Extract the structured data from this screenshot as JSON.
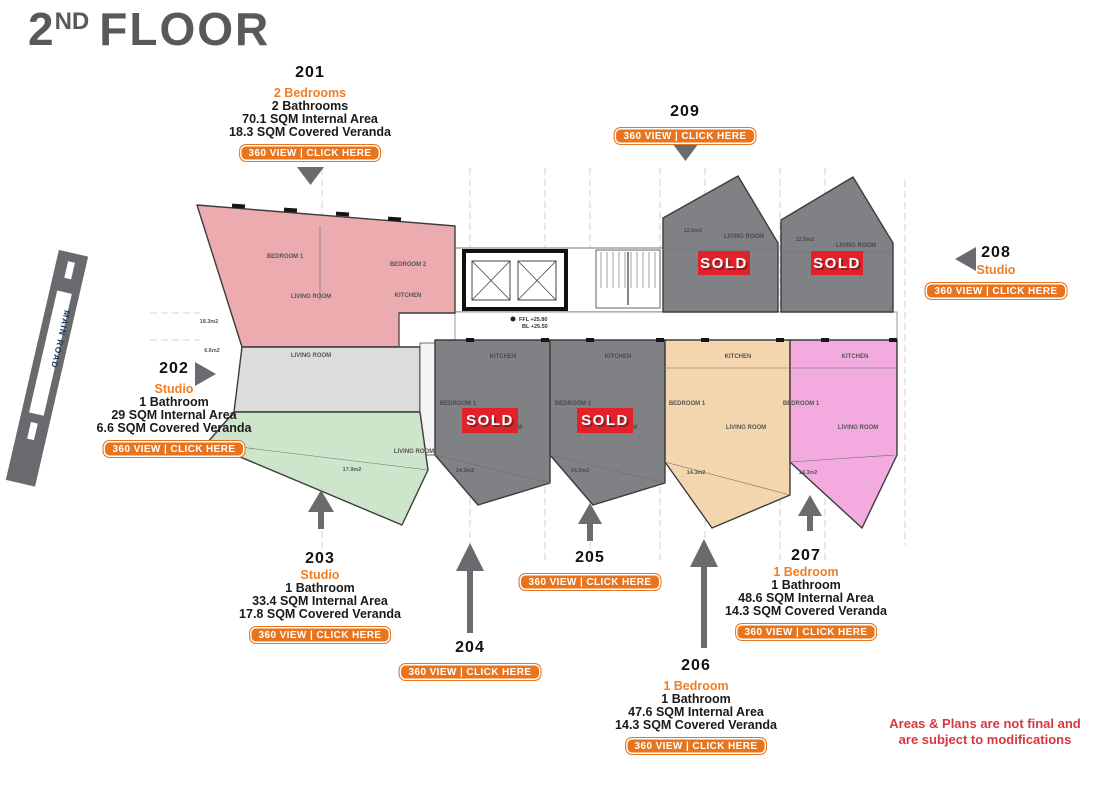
{
  "header": {
    "floor_number": "2",
    "floor_ordinal": "ND",
    "floor_word": "FLOOR"
  },
  "cta_label": "360 VIEW | CLICK HERE",
  "sold_label": "SOLD",
  "main_road_label": "MAIN ROAD",
  "disclaimer_line1": "Areas & Plans are not final and",
  "disclaimer_line2": "are subject to modifications",
  "units": {
    "u201": {
      "number": "201",
      "type": "2 Bedrooms",
      "bath": "2 Bathrooms",
      "internal": "70.1 SQM Internal Area",
      "veranda": "18.3 SQM Covered Veranda",
      "sold": false
    },
    "u202": {
      "number": "202",
      "type": "Studio",
      "bath": "1 Bathroom",
      "internal": "29 SQM Internal Area",
      "veranda": "6.6 SQM Covered Veranda",
      "sold": false
    },
    "u203": {
      "number": "203",
      "type": "Studio",
      "bath": "1 Bathroom",
      "internal": "33.4 SQM Internal Area",
      "veranda": "17.8 SQM Covered Veranda",
      "sold": false
    },
    "u204": {
      "number": "204",
      "sold": true
    },
    "u205": {
      "number": "205",
      "sold": true
    },
    "u206": {
      "number": "206",
      "type": "1 Bedroom",
      "bath": "1 Bathroom",
      "internal": "47.6 SQM Internal Area",
      "veranda": "14.3 SQM Covered Veranda",
      "sold": false
    },
    "u207": {
      "number": "207",
      "type": "1 Bedroom",
      "bath": "1 Bathroom",
      "internal": "48.6 SQM Internal Area",
      "veranda": "14.3 SQM Covered Veranda",
      "sold": false
    },
    "u208": {
      "number": "208",
      "type": "Studio",
      "sold": true
    },
    "u209": {
      "number": "209",
      "sold": true
    }
  },
  "plan": {
    "rooms": {
      "living": "LIVING ROOM",
      "kitchen": "KITCHEN",
      "bedroom1": "BEDROOM 1",
      "bedroom2": "BEDROOM 2"
    },
    "areas": {
      "a201": "18.3m2",
      "a202": "6.6m2",
      "a203": "17.9m2",
      "a204": "14.3m2",
      "a205": "14.3m2",
      "a206": "14.3m2",
      "a207": "14.3m2",
      "a208": "12.5m2",
      "a209": "12.5m2"
    },
    "levels": {
      "ffl": "FFL +25.80",
      "bl": "BL +25.50"
    }
  },
  "colors": {
    "accent_orange": "#F07E26",
    "button_orange": "#E8741E",
    "sold_red": "#E32128",
    "title_gray": "#58595B",
    "disclaimer_red": "#D6383E",
    "arrow_gray": "#6A6B6E",
    "unit201_pink": "#ECABAF",
    "unit202_gray": "#DCDCDC",
    "unit203_green": "#CDE6CB",
    "sold_unit_gray": "#7F8184",
    "unit206_tan": "#F3D6AE",
    "unit207_magenta": "#F2AADF"
  }
}
